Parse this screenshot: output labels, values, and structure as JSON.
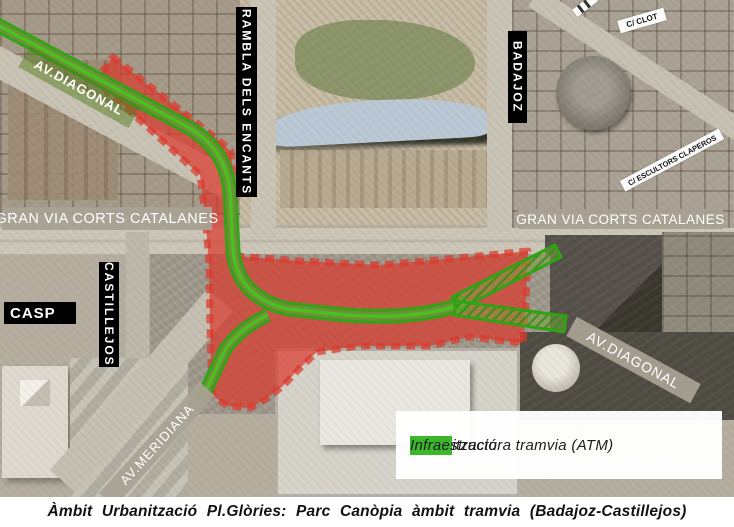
{
  "map": {
    "street_labels": {
      "av_diagonal_nw": "AV.DIAGONAL",
      "rambla_dels_encants": "RAMBLA DELS ENCANTS",
      "badajoz": "BADAJOZ",
      "c_clot": "C/ CLOT",
      "c_escultors_claperos": "C/ ESCULTORS CLAPEROS",
      "gran_via_left": "GRAN VIA CORTS CATALANES",
      "gran_via_right": "GRAN VIA CORTS CATALANES",
      "castillejos": "CASTILLEJOS",
      "casp": "CASP",
      "av_meridiana": "AV.MERIDIANA",
      "av_diagonal_se": "AV.DIAGONAL"
    },
    "overlay_colors": {
      "urbanization_zone": "#d93a2e",
      "tram_route": "#2ea414"
    }
  },
  "legend": {
    "items": [
      {
        "label": "Urbanització",
        "color": "#9e2b2b"
      },
      {
        "label": "Infraestructura tramvia (ATM)",
        "color": "#3cb72c"
      }
    ]
  },
  "caption": "Àmbit Urbanització Pl.Glòries: Parc Canòpia àmbit tramvia (Badajoz-Castillejos)"
}
